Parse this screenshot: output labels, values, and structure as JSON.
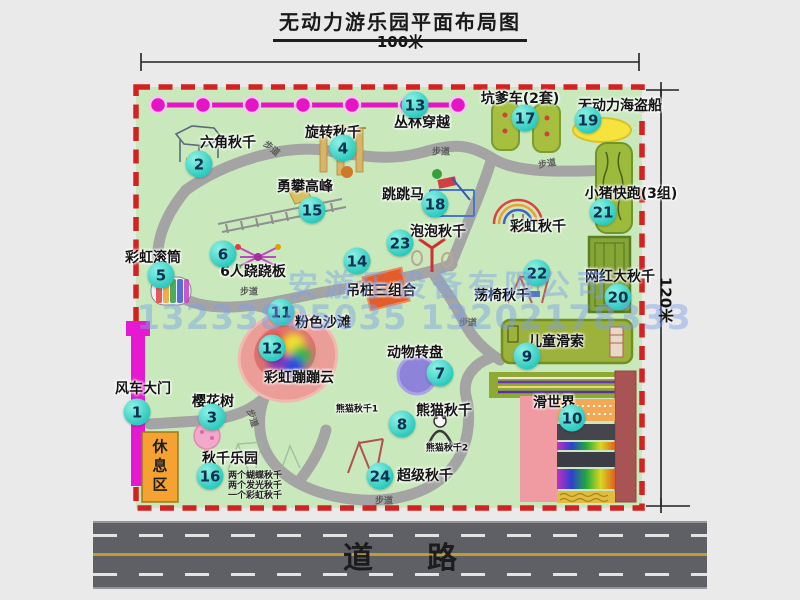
{
  "title": "无动力游乐园平面布局图",
  "dimensions": {
    "width_label": "100米",
    "height_label": "120米"
  },
  "road_label": "道路",
  "rest_area_label": "休息区",
  "trail_label": "步道",
  "watermark": {
    "line1": "安游乐设备有限公司",
    "line2": "13233805035 13202178333"
  },
  "pois": [
    {
      "num": "1",
      "name": "风车大门"
    },
    {
      "num": "2",
      "name": "六角秋千"
    },
    {
      "num": "3",
      "name": "樱花树"
    },
    {
      "num": "4",
      "name": "旋转秋千"
    },
    {
      "num": "5",
      "name": "彩虹滚筒"
    },
    {
      "num": "6",
      "name": "6人跷跷板"
    },
    {
      "num": "7",
      "name": "动物转盘"
    },
    {
      "num": "8",
      "name": "熊猫秋千"
    },
    {
      "num": "9",
      "name": "儿童滑索"
    },
    {
      "num": "10",
      "name": "滑世界"
    },
    {
      "num": "11",
      "name": "粉色沙滩"
    },
    {
      "num": "12",
      "name": "彩虹蹦蹦云"
    },
    {
      "num": "13",
      "name": "丛林穿越"
    },
    {
      "num": "14",
      "name": "吊桩三组合"
    },
    {
      "num": "15",
      "name": "勇攀高峰"
    },
    {
      "num": "16",
      "name": "秋千乐园"
    },
    {
      "num": "17",
      "name": "坑爹车(2套)"
    },
    {
      "num": "18",
      "name": "跳跳马"
    },
    {
      "num": "19",
      "name": "无动力海盗船"
    },
    {
      "num": "20",
      "name": "网红大秋千"
    },
    {
      "num": "21",
      "name": "小猪快跑(3组)"
    },
    {
      "num": "22",
      "name": "荡椅秋千"
    },
    {
      "num": "23",
      "name": "泡泡秋千"
    },
    {
      "num": "24",
      "name": "超级秋千"
    }
  ],
  "extras": {
    "rainbow_swing": "彩虹秋千",
    "panda_swing_1": "熊猫秋千1",
    "panda_swing_2": "熊猫秋千2",
    "swing_park_notes": [
      "两个蝴蝶秋千",
      "两个发光秋千",
      "一个彩虹秋千"
    ]
  },
  "colors": {
    "map_green": "#c9e9bc",
    "border_red": "#d42121",
    "badge_teal": "#2cc9bd",
    "jungle_magenta": "#e515c5",
    "road_gray": "#5f5f66",
    "rest_orange": "#f5a233"
  }
}
